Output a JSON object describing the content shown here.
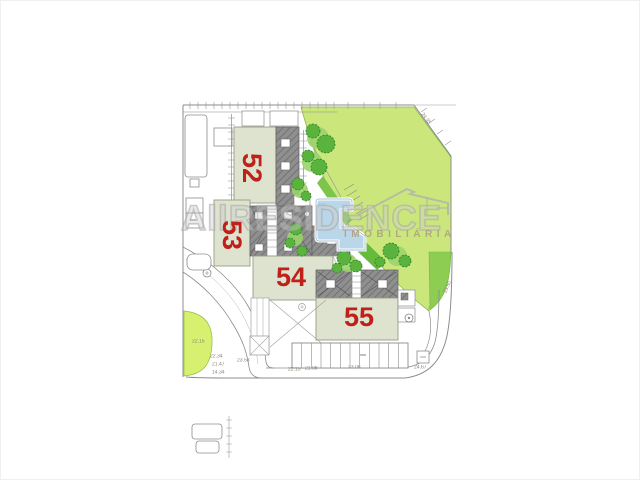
{
  "watermark": {
    "prefix": "All",
    "name": "RESIDENCE",
    "subtitle": "IMOBILIÁRIA",
    "logo": "house-roof-outline"
  },
  "buildings": [
    {
      "number": "52",
      "rotated": true
    },
    {
      "number": "53",
      "rotated": true
    },
    {
      "number": "54",
      "rotated": false
    },
    {
      "number": "55",
      "rotated": false
    }
  ],
  "dimension_labels": [
    {
      "text": "24.35"
    },
    {
      "text": "23.50"
    },
    {
      "text": "22.15"
    },
    {
      "text": "22.34"
    },
    {
      "text": "21.47"
    },
    {
      "text": "14.34"
    },
    {
      "text": "23.53"
    },
    {
      "text": "22.15"
    },
    {
      "text": "21.98"
    },
    {
      "text": "23.08"
    },
    {
      "text": "24.67"
    }
  ],
  "colors": {
    "number_red": "#bf2018",
    "green_light": "#cbe77c",
    "green_patch": "#d7f06f",
    "tree_dark": "#59b33c",
    "building_fill": "#dde3cf",
    "roof_gray": "#8f8f8f",
    "pool_blue": "#bad7ea",
    "line_gray": "#8c8c8c"
  }
}
